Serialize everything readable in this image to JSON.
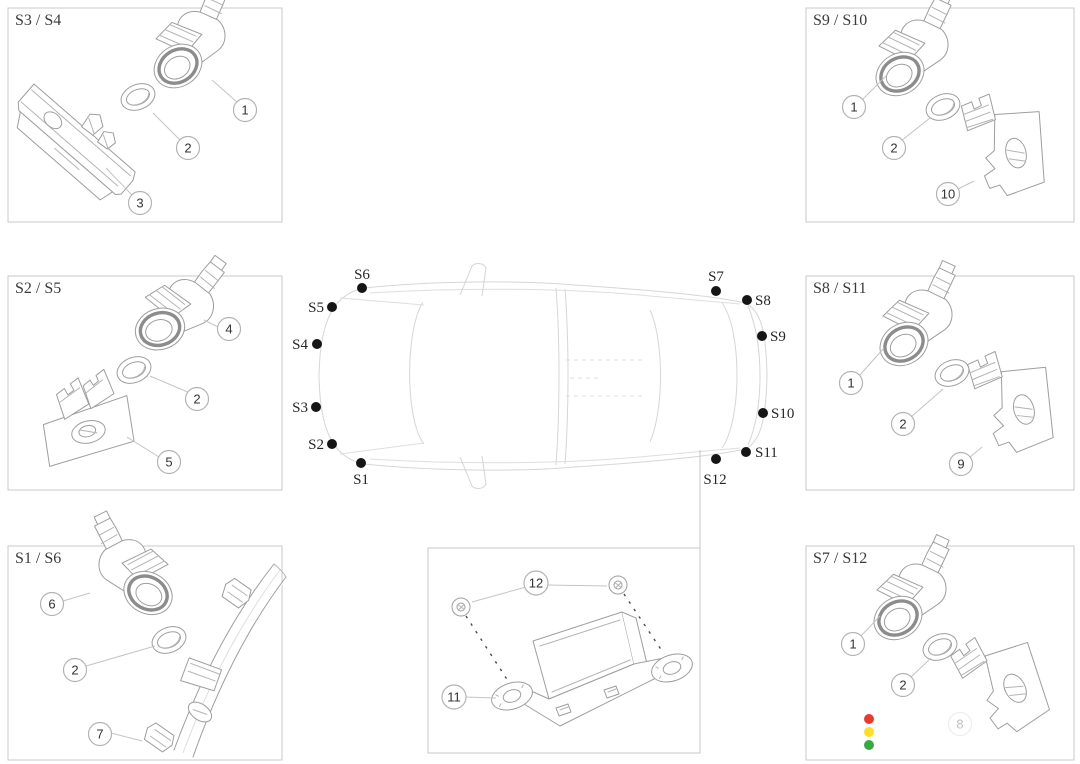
{
  "panels": {
    "top_left": {
      "label": "S3 / S4",
      "callouts": [
        "1",
        "2",
        "3"
      ]
    },
    "mid_left": {
      "label": "S2 / S5",
      "callouts": [
        "4",
        "2",
        "5"
      ]
    },
    "bottom_left": {
      "label": "S1 / S6",
      "callouts": [
        "6",
        "2",
        "7"
      ]
    },
    "top_right": {
      "label": "S9 / S10",
      "callouts": [
        "1",
        "2",
        "10"
      ]
    },
    "mid_right": {
      "label": "S8 / S11",
      "callouts": [
        "1",
        "2",
        "9"
      ]
    },
    "bottom_right": {
      "label": "S7 / S12",
      "callouts": [
        "1",
        "2",
        "8"
      ]
    },
    "bottom_center": {
      "callouts": [
        "11",
        "12"
      ]
    }
  },
  "car": {
    "sensors": [
      "S1",
      "S2",
      "S3",
      "S4",
      "S5",
      "S6",
      "S7",
      "S8",
      "S9",
      "S10",
      "S11",
      "S12"
    ]
  },
  "status_lights": {
    "red": "#e8392f",
    "yellow": "#ffdf26",
    "green": "#3aa745"
  }
}
